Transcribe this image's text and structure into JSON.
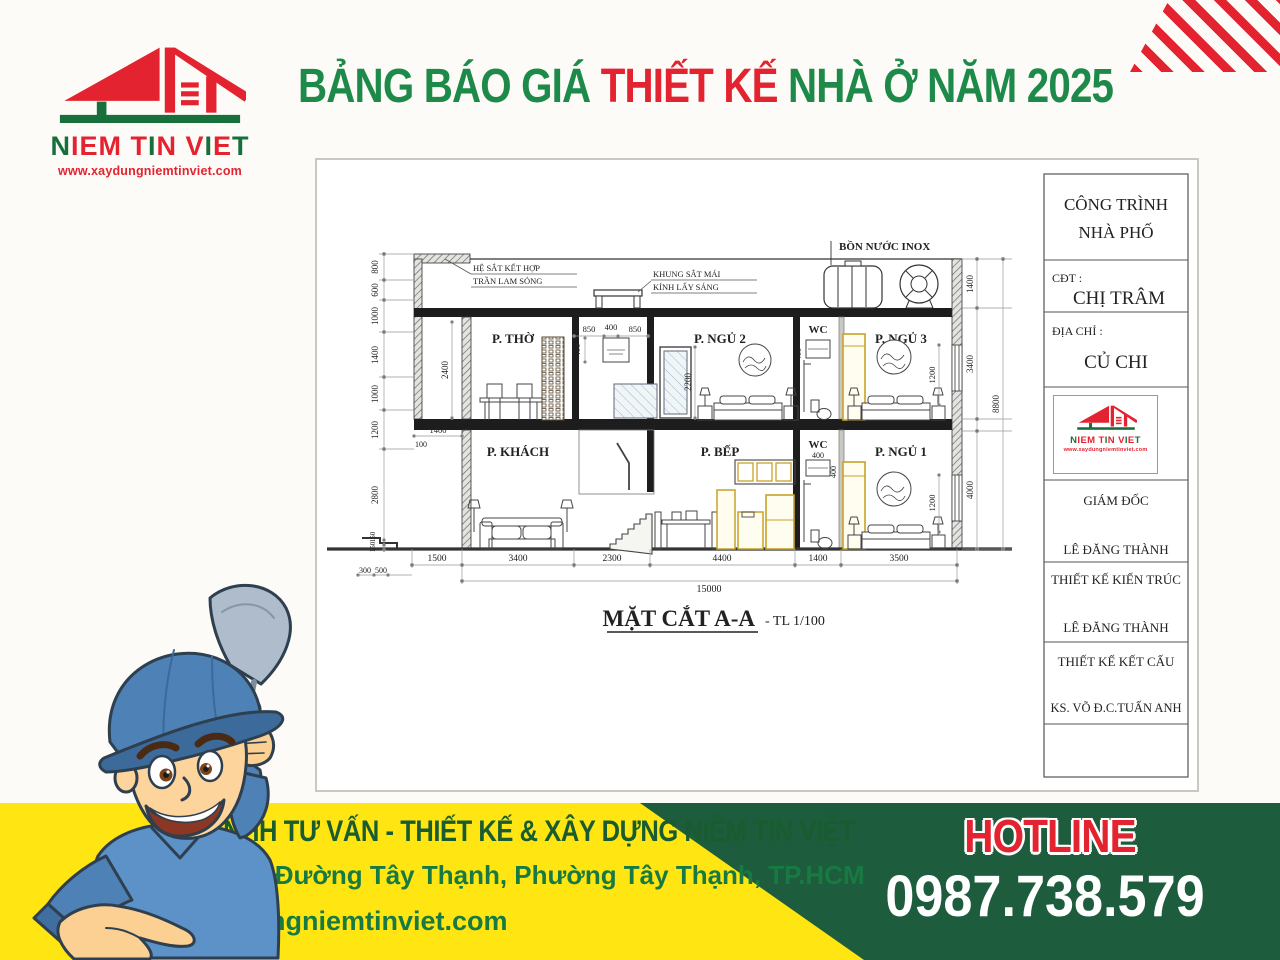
{
  "colors": {
    "green": "#1e8a4a",
    "dark_green": "#1d5c3c",
    "red": "#e42330",
    "yellow": "#ffe512",
    "highlight": "#c9a227"
  },
  "logo": {
    "segments": [
      {
        "t": "N",
        "c": "g"
      },
      {
        "t": "IEM",
        "c": "r"
      },
      {
        "t": " ",
        "c": "r"
      },
      {
        "t": "T",
        "c": "r"
      },
      {
        "t": "I",
        "c": "g"
      },
      {
        "t": "N",
        "c": "r"
      },
      {
        "t": " ",
        "c": "r"
      },
      {
        "t": "V",
        "c": "r"
      },
      {
        "t": "I",
        "c": "g"
      },
      {
        "t": "E",
        "c": "r"
      },
      {
        "t": "T",
        "c": "g"
      }
    ],
    "website": "www.xaydungniemtinviet.com"
  },
  "header": {
    "title": {
      "p1": "BẢNG BÁO GIÁ ",
      "p2": "THIẾT KẾ",
      "p3": " NHÀ Ở NĂM 2025"
    }
  },
  "drawing": {
    "section_title": "MẶT CẮT A-A",
    "section_scale": "- TL 1/100",
    "labels": {
      "tank": "BỒN NƯỚC INOX",
      "ceiling_1": "HỆ SẮT KẾT HỢP",
      "ceiling_2": "TRẦN LAM SÓNG",
      "skylight_1": "KHUNG SẮT MÁI",
      "skylight_2": "KÍNH LẤY SÁNG"
    },
    "rooms": {
      "upper": [
        "P. THỜ",
        "P. NGỦ 2",
        "WC",
        "P. NGỦ 3"
      ],
      "lower": [
        "P. KHÁCH",
        "P. BẾP",
        "WC",
        "P. NGỦ 1"
      ]
    },
    "dims": {
      "left": [
        "800",
        "600",
        "1000",
        "1400",
        "1000",
        "1200",
        "2800",
        "150",
        "150"
      ],
      "right": [
        "1400",
        "3400",
        "4000",
        "8800"
      ],
      "bottom": [
        "1500",
        "3400",
        "2300",
        "4400",
        "1400",
        "3500"
      ],
      "total": "15000",
      "steps": [
        "300",
        "500"
      ],
      "upper": [
        "2400",
        "1400",
        "100",
        "850",
        "400",
        "850",
        "400",
        "2200",
        "400",
        "1200"
      ],
      "lower": [
        "400",
        "400",
        "1200"
      ]
    },
    "title_block": {
      "project_line1": "CÔNG TRÌNH",
      "project_line2": "NHÀ PHỐ",
      "cdt_label": "CĐT :",
      "cdt_name": "CHỊ TRÂM",
      "addr_label": "ĐỊA CHỈ :",
      "addr_name": "CỦ CHI",
      "director_label": "GIÁM ĐỐC",
      "director_name": "LÊ ĐĂNG THÀNH",
      "arch_label": "THIẾT KẾ KIẾN TRÚC",
      "arch_name": "LÊ ĐĂNG THÀNH",
      "struct_label": "THIẾT KẾ KẾT CẤU",
      "struct_name": "KS. VÕ Đ.C.TUẤN ANH"
    }
  },
  "footer": {
    "company": "CTY TNHH TƯ VẤN - THIẾT KẾ & XÂY DỰNG NIỀM TIN VIỆT",
    "address": "242/47 Đường Tây Thạnh, Phường Tây Thạnh, TP.HCM",
    "website": "Xaydungniemtinviet.com",
    "hotline_label": "HOTLINE",
    "hotline_number": "0987.738.579"
  }
}
